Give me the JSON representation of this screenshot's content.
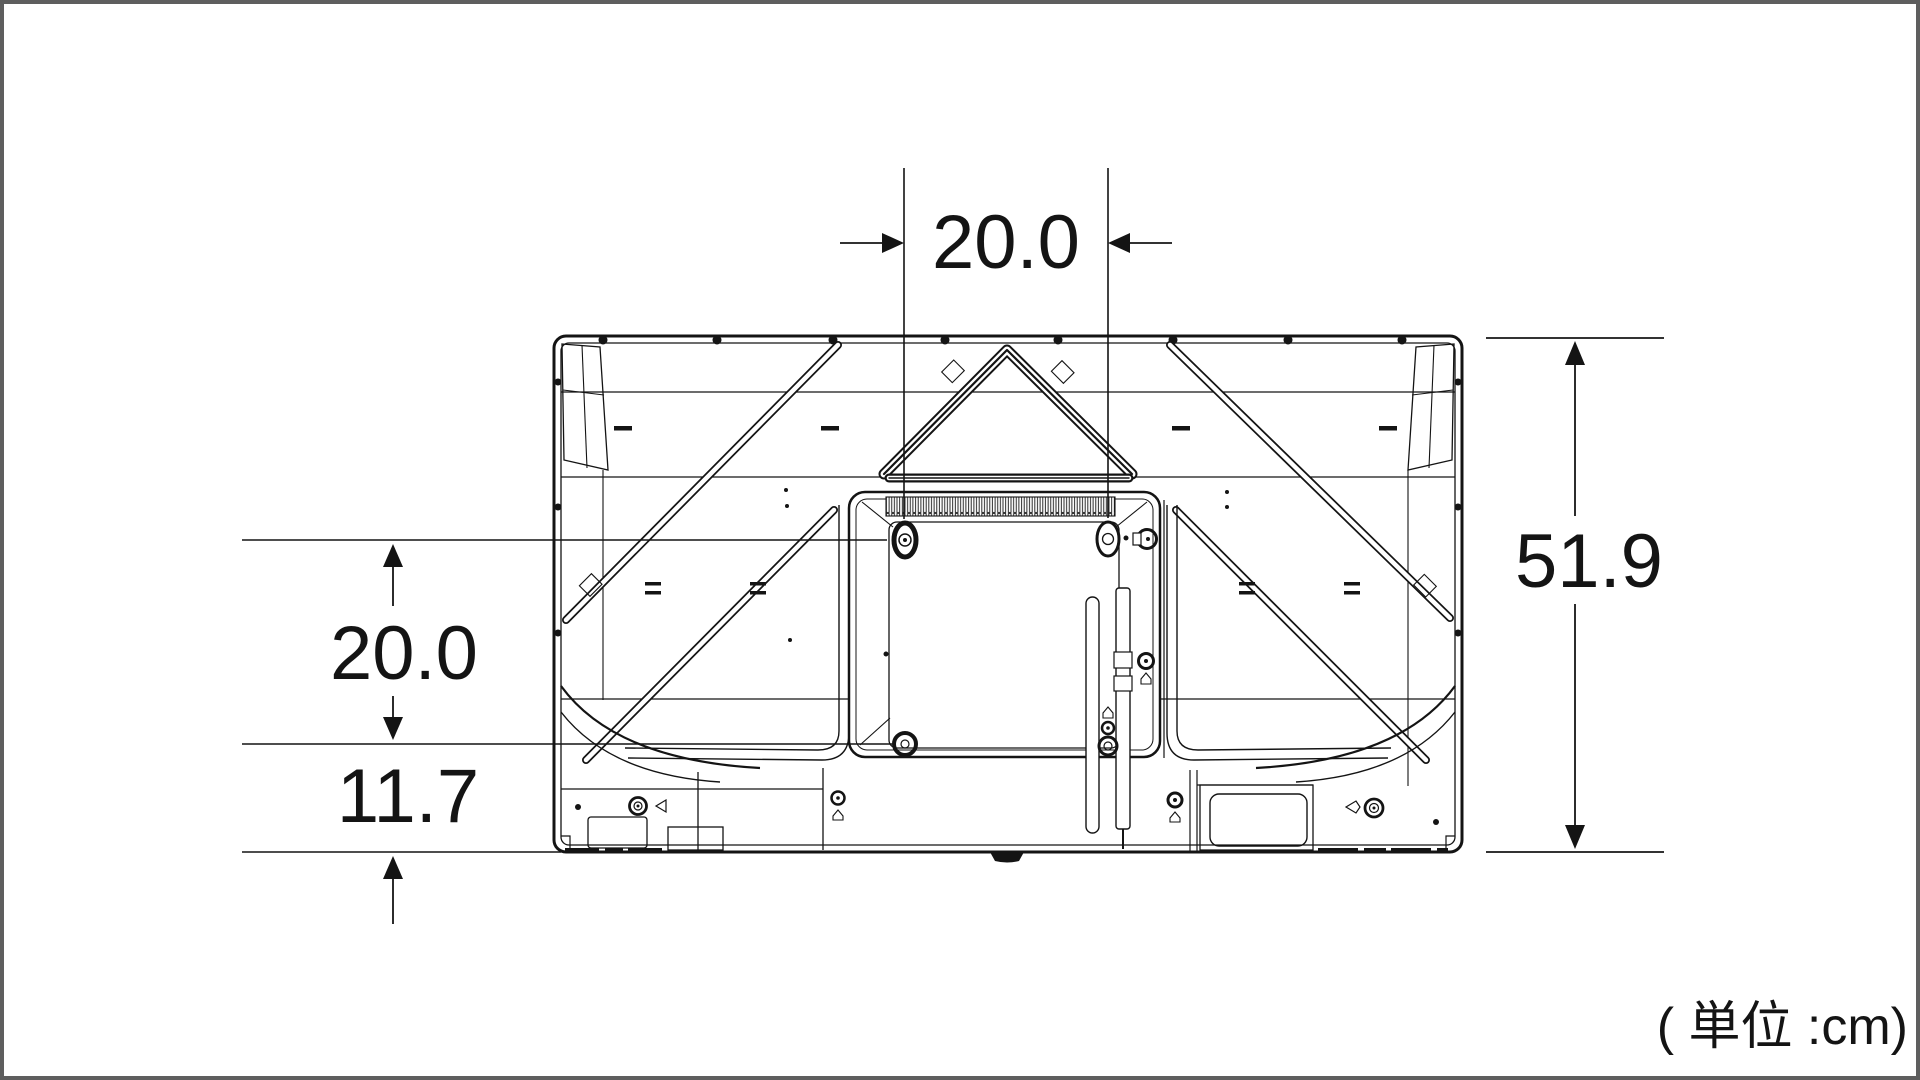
{
  "diagram": {
    "dimensions": {
      "top_width": "20.0",
      "left_vertical": "20.0",
      "left_bottom_offset": "11.7",
      "right_height": "51.9"
    },
    "unit_label": "( 単位 :cm)",
    "colors": {
      "line": "#141414",
      "frame_border": "#5e5e5e",
      "background": "#ffffff"
    }
  }
}
